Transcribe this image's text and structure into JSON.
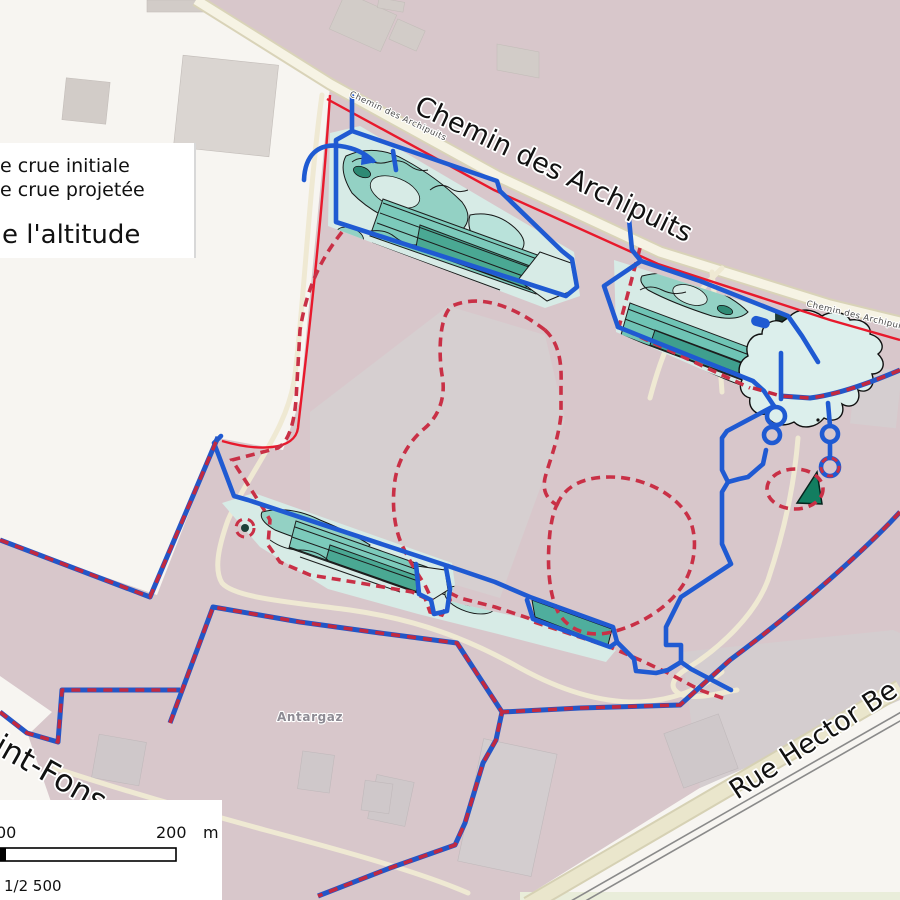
{
  "map": {
    "streets": {
      "main": "Chemin des Archipuits",
      "rue_hector": "Rue Hector Be",
      "saint_fons": "int-Fons"
    },
    "poi": {
      "antargaz": "Antargaz"
    },
    "legend": {
      "line1": "de crue initiale",
      "line2": "de crue projetée",
      "line3": "e l'altitude"
    },
    "scalebar": {
      "left_label": "00",
      "right_label": "200",
      "unit": "m",
      "scale_ratio": "1/2 500"
    },
    "colors": {
      "background": "#d8c7cb",
      "white_area": "#f7f5f1",
      "flood_initial_outline_blue": "#1f5ad2",
      "flood_projected_dash_red": "#c93046",
      "boundary_blue": "#2356c7",
      "road_red_line": "#e8192c",
      "contour_teal_light": "#d7ebe6",
      "contour_teal_mid": "#7ccabb",
      "contour_teal_dark": "#4aa893",
      "green_patch": "#127e60"
    }
  }
}
